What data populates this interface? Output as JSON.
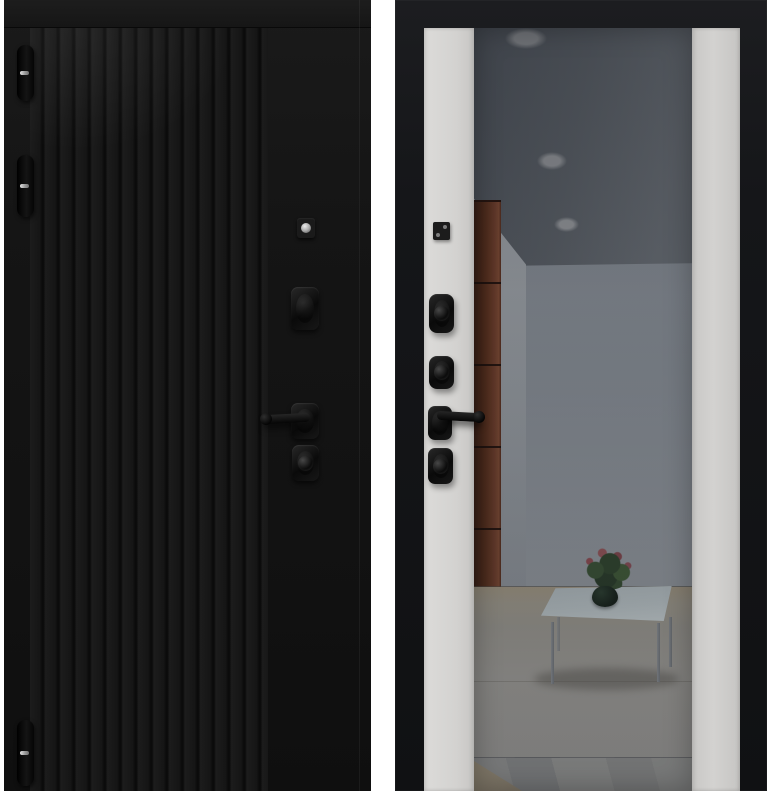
{
  "meta": {
    "description": "Product photograph of a steel entry door shown from both sides: black fluted exterior panel (left) and interior side with full-height tinted mirror flanked by light panels (right)",
    "text_content": "none — image contains no rendered text"
  },
  "colors": {
    "page-bg": "#ffffff",
    "flute-light": "#1c1c1c",
    "flute-dark": "#0b0b0b",
    "ceiling-dark": "#555a61",
    "wall-top": "#8b9199",
    "wall-bottom": "#a2a7ad",
    "cabinet-dark": "#3f1d10",
    "cabinet-light": "#7b432c",
    "floor-beige": "#b3a68e",
    "floor-main": "#aca89e",
    "glass-top": "#c2cccf",
    "pot": "#152017"
  },
  "exterior_door": {
    "finish": "matte black with vertical fluted millwork",
    "hinges": 3,
    "hardware": [
      "lock-cylinder",
      "upper-lock-escutcheon",
      "lever-handle-left",
      "lower-lock-escutcheon"
    ]
  },
  "interior_door": {
    "finish": "black frame, light gray side panels, full-height tinted mirror insert",
    "hardware": [
      "cylinder-cover-plate",
      "upper-thumbturn",
      "middle-thumbturn",
      "lever-handle-right",
      "lower-thumbturn"
    ]
  },
  "mirror_reflection": {
    "ceiling_lights": 3,
    "items": [
      "recessed-ceiling-lights",
      "brown-cabinet",
      "glass-coffee-table",
      "potted-plant-with-red-flowers",
      "beige-tiled-floor"
    ]
  }
}
